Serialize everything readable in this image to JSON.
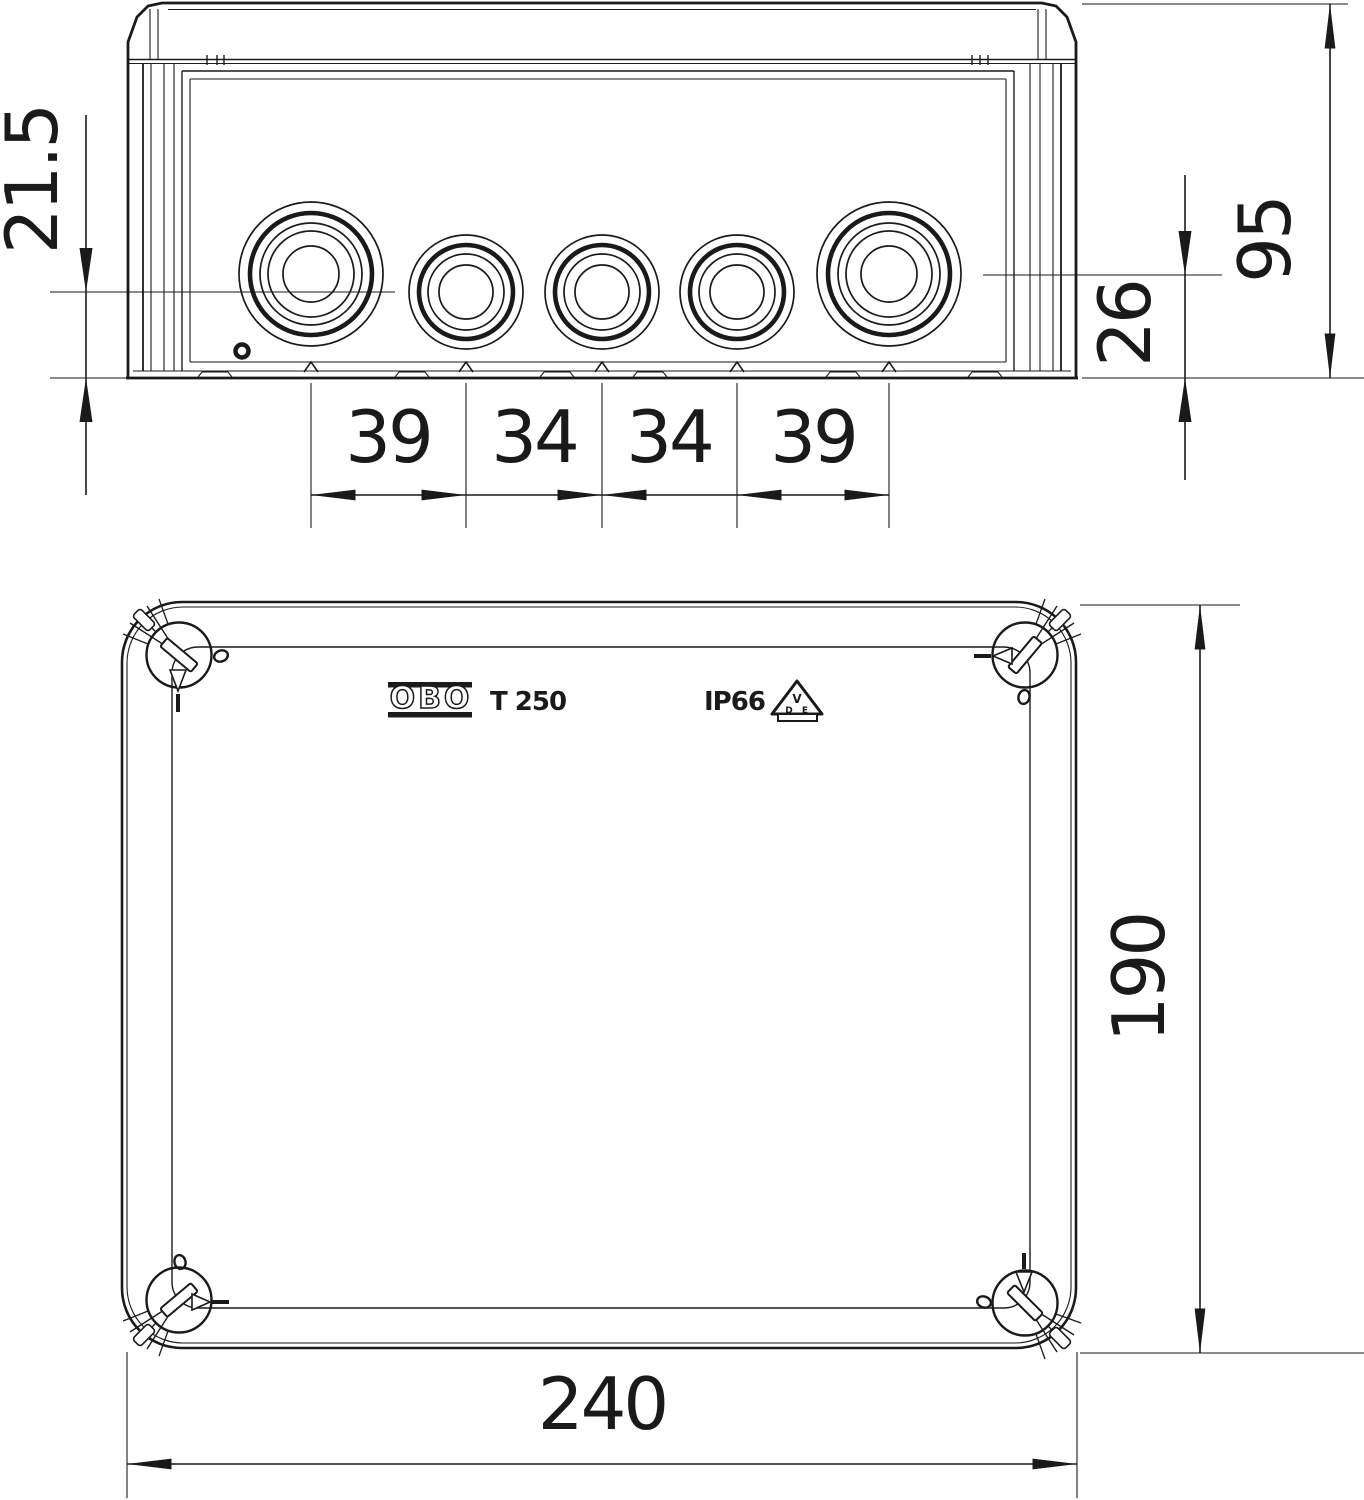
{
  "document": {
    "type": "technical dimensional drawing",
    "product": "OBO T 250 cable junction box"
  },
  "colors": {
    "line": "#1a1a1a",
    "background": "#ffffff"
  },
  "side_view": {
    "dim_entry_center_small": "21.5",
    "dim_height": "95",
    "dim_entry_center_large": "26",
    "dim_spacing": [
      "39",
      "34",
      "34",
      "39"
    ]
  },
  "bottom_view": {
    "dim_width": "240",
    "dim_length": "190",
    "brand": "OBO",
    "model": "T 250",
    "ip_rating": "IP66",
    "vde_letters": [
      "V",
      "D",
      "E"
    ]
  }
}
